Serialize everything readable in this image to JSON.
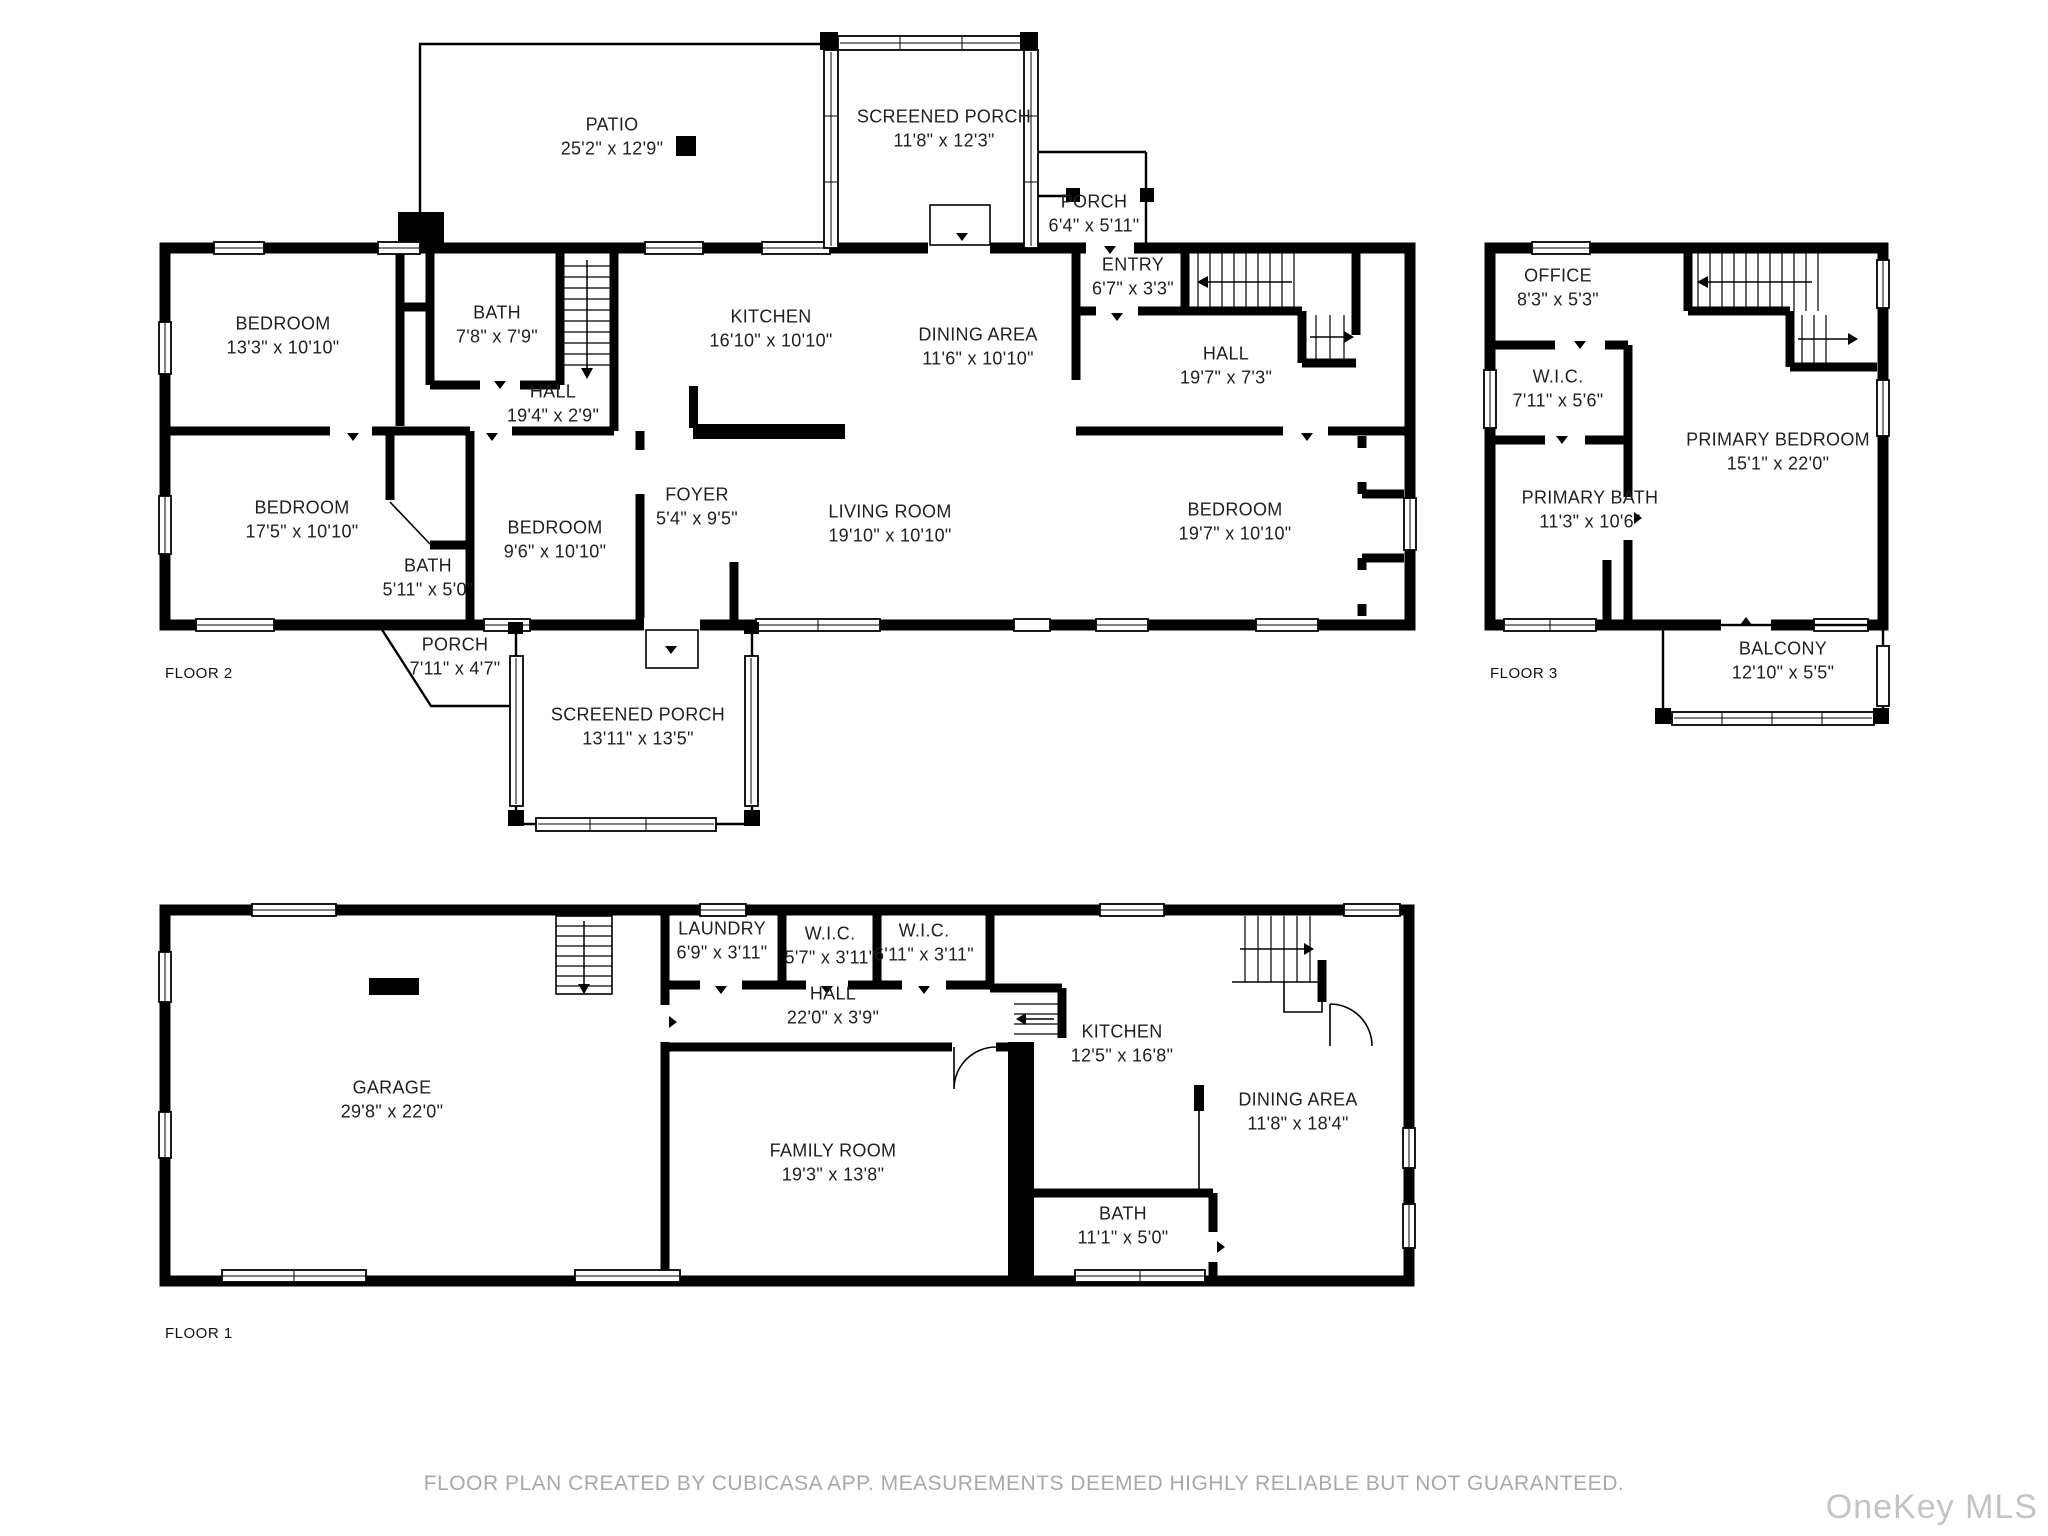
{
  "floors": [
    {
      "label": "FLOOR 2",
      "rooms": [
        {
          "name": "PATIO",
          "dims": "25'2\" x 12'9\""
        },
        {
          "name": "SCREENED PORCH",
          "dims": "11'8\" x 12'3\""
        },
        {
          "name": "PORCH",
          "dims": "6'4\" x 5'11\""
        },
        {
          "name": "ENTRY",
          "dims": "6'7\" x 3'3\""
        },
        {
          "name": "BEDROOM",
          "dims": "13'3\" x 10'10\""
        },
        {
          "name": "BATH",
          "dims": "7'8\" x 7'9\""
        },
        {
          "name": "KITCHEN",
          "dims": "16'10\" x 10'10\""
        },
        {
          "name": "DINING AREA",
          "dims": "11'6\" x 10'10\""
        },
        {
          "name": "HALL",
          "dims": "19'7\" x 7'3\""
        },
        {
          "name": "HALL",
          "dims": "19'4\" x 2'9\""
        },
        {
          "name": "BEDROOM",
          "dims": "17'5\" x 10'10\""
        },
        {
          "name": "BATH",
          "dims": "5'11\" x 5'0\""
        },
        {
          "name": "BEDROOM",
          "dims": "9'6\" x 10'10\""
        },
        {
          "name": "FOYER",
          "dims": "5'4\" x 9'5\""
        },
        {
          "name": "LIVING ROOM",
          "dims": "19'10\" x 10'10\""
        },
        {
          "name": "BEDROOM",
          "dims": "19'7\" x 10'10\""
        },
        {
          "name": "PORCH",
          "dims": "7'11\" x 4'7\""
        },
        {
          "name": "SCREENED PORCH",
          "dims": "13'11\" x 13'5\""
        }
      ]
    },
    {
      "label": "FLOOR 3",
      "rooms": [
        {
          "name": "OFFICE",
          "dims": "8'3\" x 5'3\""
        },
        {
          "name": "W.I.C.",
          "dims": "7'11\" x 5'6\""
        },
        {
          "name": "PRIMARY BEDROOM",
          "dims": "15'1\" x 22'0\""
        },
        {
          "name": "PRIMARY BATH",
          "dims": "11'3\" x 10'6\""
        },
        {
          "name": "BALCONY",
          "dims": "12'10\" x 5'5\""
        }
      ]
    },
    {
      "label": "FLOOR 1",
      "rooms": [
        {
          "name": "GARAGE",
          "dims": "29'8\" x 22'0\""
        },
        {
          "name": "LAUNDRY",
          "dims": "6'9\" x 3'11\""
        },
        {
          "name": "W.I.C.",
          "dims": "5'7\" x 3'11\""
        },
        {
          "name": "W.I.C.",
          "dims": "6'11\" x 3'11\""
        },
        {
          "name": "HALL",
          "dims": "22'0\" x 3'9\""
        },
        {
          "name": "KITCHEN",
          "dims": "12'5\" x 16'8\""
        },
        {
          "name": "DINING AREA",
          "dims": "11'8\" x 18'4\""
        },
        {
          "name": "FAMILY ROOM",
          "dims": "19'3\" x 13'8\""
        },
        {
          "name": "BATH",
          "dims": "11'1\" x 5'0\""
        }
      ]
    }
  ],
  "footer": {
    "disclaimer": "FLOOR PLAN CREATED BY CUBICASA APP. MEASUREMENTS DEEMED HIGHLY RELIABLE BUT NOT GUARANTEED."
  },
  "watermark": {
    "text": "OneKey MLS"
  },
  "colors": {
    "wall": "#000000",
    "background": "#ffffff",
    "label_text": "#1f1f1f",
    "footer_text": "#a8a8a8",
    "watermark_text": "#c3c3c3"
  }
}
